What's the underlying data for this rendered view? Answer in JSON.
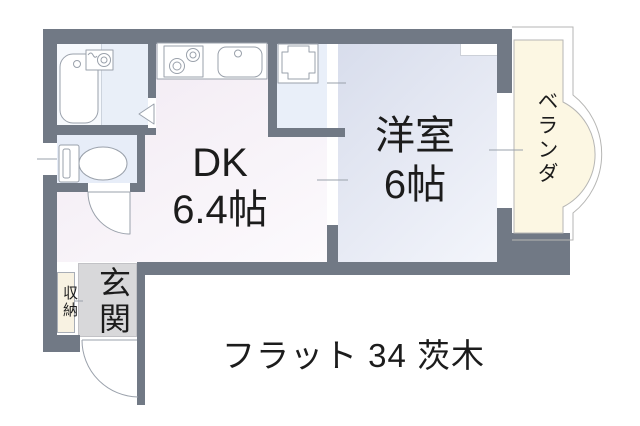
{
  "floor_plan": {
    "rooms": {
      "dk": {
        "name": "DK",
        "area": "6.4帖"
      },
      "western_room": {
        "name": "洋室",
        "area": "6帖"
      },
      "veranda": {
        "label": "ベランダ"
      },
      "entrance": {
        "label": "玄関"
      },
      "storage": {
        "label": "収納"
      }
    },
    "caption": "フラット 34 茨木"
  },
  "colors": {
    "wall": "#717985",
    "dk_start": "#f1e9f2",
    "dk_end": "#fcfafd",
    "western_start": "#d8ddec",
    "western_end": "#f3f5fb",
    "bath_tub_zone": "#f6f9fd",
    "bath_wash_zone": "#e9eff8",
    "toilet": "#e7edf8",
    "alcove": "#e9eff9",
    "veranda": "#fcf7e3",
    "entrance_floor": "#d8d8da",
    "storage_fill": "#f8f2e2",
    "fixture_stroke": "#9aa1ab",
    "thin_outline": "#b6b6b4",
    "text": "#1c1c1c"
  }
}
